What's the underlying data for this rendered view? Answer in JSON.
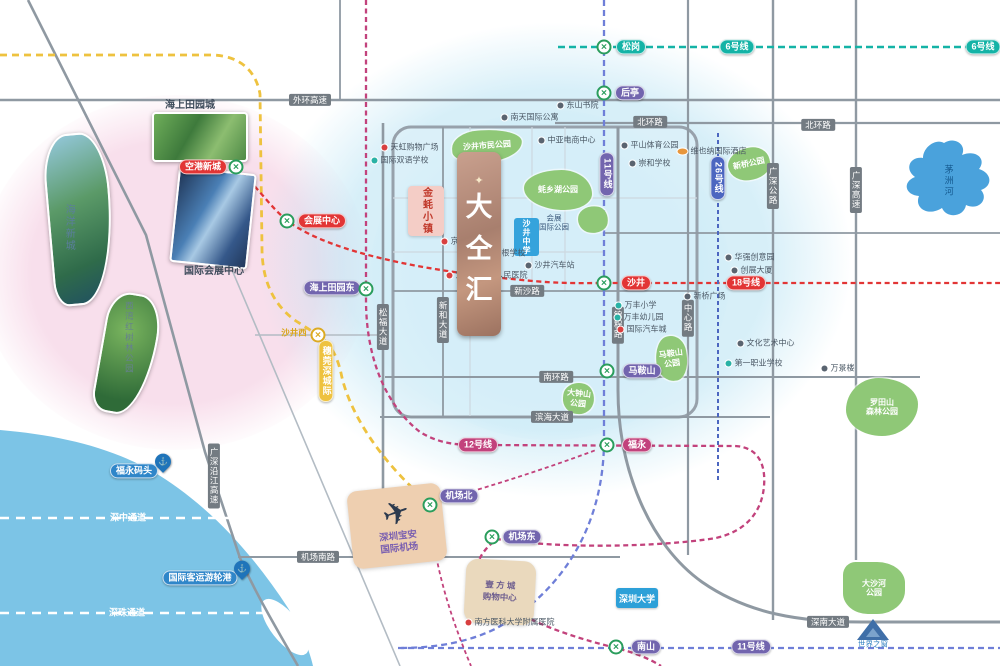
{
  "canvas": {
    "width": 1000,
    "height": 666
  },
  "colors": {
    "sea": "#7cc4e6",
    "river": "#4aa2dc",
    "line6": "#14b3a6",
    "line11": "#6f7fd8",
    "line11_badge": "#7265ae",
    "line12": "#c2427c",
    "line18": "#e23535",
    "line26": "#4c66c0",
    "intercity": "#eec23f",
    "road_badge": "#737b82",
    "park": "#8fc877",
    "station_ring": "#2a9d5c",
    "station_ring_yellow": "#dcaa22"
  },
  "line_badges": [
    {
      "id": "line6-a",
      "text": "6号线",
      "x": 737,
      "y": 47,
      "bg": "#14b3a6"
    },
    {
      "id": "line6-b",
      "text": "6号线",
      "x": 983,
      "y": 47,
      "bg": "#14b3a6"
    },
    {
      "id": "line11-v",
      "text": "11号线",
      "x": 607,
      "y": 174,
      "bg": "#7265ae",
      "vert": true
    },
    {
      "id": "line11-h",
      "text": "11号线",
      "x": 751,
      "y": 647,
      "bg": "#7265ae"
    },
    {
      "id": "line12",
      "text": "12号线",
      "x": 478,
      "y": 445,
      "bg": "#c2427c"
    },
    {
      "id": "line18",
      "text": "18号线",
      "x": 746,
      "y": 283,
      "bg": "#e23535"
    },
    {
      "id": "line26",
      "text": "26号线",
      "x": 718,
      "y": 178,
      "bg": "#4c66c0",
      "vert": true
    },
    {
      "id": "intercity",
      "text": "穗莞深城际",
      "x": 326,
      "y": 371,
      "bg": "#eec23f",
      "vert": true
    }
  ],
  "stations": [
    {
      "id": "songgang",
      "name": "松岗",
      "ix": 604,
      "iy": 47,
      "lx": 631,
      "ly": 47,
      "bg": "#14b3a6"
    },
    {
      "id": "houting",
      "name": "后亭",
      "ix": 604,
      "iy": 93,
      "lx": 630,
      "ly": 93,
      "bg": "#7265ae"
    },
    {
      "id": "shajing",
      "name": "沙井",
      "ix": 604,
      "iy": 283,
      "lx": 636,
      "ly": 283,
      "bg": "#e23535"
    },
    {
      "id": "maanshan",
      "name": "马鞍山",
      "ix": 607,
      "iy": 371,
      "lx": 642,
      "ly": 371,
      "bg": "#7265ae"
    },
    {
      "id": "fuyong",
      "name": "福永",
      "ix": 607,
      "iy": 445,
      "lx": 637,
      "ly": 445,
      "bg": "#c2427c"
    },
    {
      "id": "haishangtianyuandong",
      "name": "海上田园东",
      "ix": 366,
      "iy": 289,
      "lx": 332,
      "ly": 288,
      "bg": "#7265ae"
    },
    {
      "id": "konggangxincheng",
      "name": "空港新城",
      "ix": 236,
      "iy": 167,
      "lx": 203,
      "ly": 167,
      "bg": "#e23535"
    },
    {
      "id": "huizhanzhongxin",
      "name": "会展中心",
      "ix": 287,
      "iy": 221,
      "lx": 322,
      "ly": 221,
      "bg": "#e23535"
    },
    {
      "id": "jichangbei",
      "name": "机场北",
      "ix": 430,
      "iy": 505,
      "lx": 459,
      "ly": 496,
      "bg": "#7265ae"
    },
    {
      "id": "jichangdong",
      "name": "机场东",
      "ix": 492,
      "iy": 537,
      "lx": 522,
      "ly": 537,
      "bg": "#7265ae"
    },
    {
      "id": "nanshan",
      "name": "南山",
      "ix": 616,
      "iy": 647,
      "lx": 646,
      "ly": 647,
      "bg": "#7265ae"
    },
    {
      "id": "shajingxi",
      "name": "沙井西",
      "ix": 318,
      "iy": 335,
      "lx": 294,
      "ly": 333,
      "plain": true,
      "color": "#d9a61e",
      "yellow": true
    }
  ],
  "road_badges": [
    {
      "id": "waihuan-expwy",
      "text": "外环高速",
      "x": 310,
      "y": 100
    },
    {
      "id": "beihuan-rd-1",
      "text": "北环路",
      "x": 650,
      "y": 122
    },
    {
      "id": "beihuan-rd-2",
      "text": "北环路",
      "x": 818,
      "y": 125
    },
    {
      "id": "xinsha-rd",
      "text": "新沙路",
      "x": 527,
      "y": 291
    },
    {
      "id": "nanhuan-rd",
      "text": "南环路",
      "x": 556,
      "y": 377
    },
    {
      "id": "binhai-ave",
      "text": "滨海大道",
      "x": 552,
      "y": 417
    },
    {
      "id": "jichangnan-rd",
      "text": "机场南路",
      "x": 318,
      "y": 557
    },
    {
      "id": "shennan-ave",
      "text": "深南大道",
      "x": 828,
      "y": 622
    },
    {
      "id": "songfu-ave",
      "text": "松福大道",
      "x": 383,
      "y": 327,
      "vert": true
    },
    {
      "id": "xinhe-ave",
      "text": "新和大道",
      "x": 443,
      "y": 320,
      "vert": true
    },
    {
      "id": "jincheng-rd",
      "text": "锦程路",
      "x": 618,
      "y": 325,
      "vert": true
    },
    {
      "id": "zhongxin-rd",
      "text": "中心路",
      "x": 688,
      "y": 318,
      "vert": true
    },
    {
      "id": "guangshen-hwy",
      "text": "广深公路",
      "x": 773,
      "y": 186,
      "vert": true
    },
    {
      "id": "guangshen-expwy",
      "text": "广深高速",
      "x": 856,
      "y": 190,
      "vert": true
    },
    {
      "id": "yanjiang-expwy",
      "text": "广深沿江高速",
      "x": 214,
      "y": 476,
      "vert": true
    }
  ],
  "parks": [
    {
      "id": "shimin-park",
      "lines": [
        "沙井市民公园"
      ],
      "x": 452,
      "y": 130,
      "w": 70,
      "h": 32,
      "rot": -4,
      "br": "40% 60% 55% 45%/55% 45% 60% 40%"
    },
    {
      "id": "haoxianghu-park",
      "lines": [
        "蚝乡湖公园"
      ],
      "x": 524,
      "y": 170,
      "w": 68,
      "h": 40,
      "rot": 0,
      "br": "55% 45% 40% 60%/45% 60% 40% 55%"
    },
    {
      "id": "huizhan-intl-park",
      "lines": [],
      "x": 578,
      "y": 206,
      "w": 30,
      "h": 27,
      "rot": 10,
      "br": "60% 40% 55% 45%/50% 55% 45% 50%"
    },
    {
      "id": "maanshan-park",
      "lines": [
        "马鞍山",
        "公园"
      ],
      "x": 656,
      "y": 336,
      "w": 31,
      "h": 45,
      "rot": -8,
      "br": "50% 50% 45% 55%/60% 40% 55% 45%"
    },
    {
      "id": "dazhongshan-park",
      "lines": [
        "大钟山",
        "公园"
      ],
      "x": 563,
      "y": 383,
      "w": 31,
      "h": 31,
      "rot": 6,
      "br": "55% 45% 50% 50%/45% 55% 50% 50%"
    },
    {
      "id": "luotianshan-park",
      "lines": [
        "罗田山",
        "森林公园"
      ],
      "x": 846,
      "y": 378,
      "w": 72,
      "h": 58,
      "rot": 0,
      "br": "45% 55% 50% 50%/55% 45% 55% 45%"
    },
    {
      "id": "dashahe-park",
      "lines": [
        "大沙河",
        "公园"
      ],
      "x": 843,
      "y": 562,
      "w": 62,
      "h": 52,
      "rot": 0,
      "br": "20% 45% 45% 40%/25% 40% 45% 40%"
    },
    {
      "id": "xinqiao-park",
      "lines": [
        "新桥公园"
      ],
      "x": 728,
      "y": 148,
      "w": 42,
      "h": 32,
      "rot": -12,
      "br": "55% 45% 50% 50%/50% 50% 45% 55%"
    }
  ],
  "pois": [
    {
      "text": "天虹购物广场",
      "x": 410,
      "y": 147,
      "c": "r"
    },
    {
      "text": "国际双语学校",
      "x": 400,
      "y": 160,
      "c": "t"
    },
    {
      "text": "中亚电商中心",
      "x": 567,
      "y": 140,
      "c": "d"
    },
    {
      "text": "荣根学校",
      "x": 505,
      "y": 253,
      "c": "b"
    },
    {
      "text": "京基百纳广场",
      "x": 470,
      "y": 241,
      "c": "r"
    },
    {
      "text": "宝安区沙井人民医院",
      "x": 487,
      "y": 275,
      "c": "r"
    },
    {
      "text": "沙井汽车站",
      "x": 550,
      "y": 265,
      "c": "d"
    },
    {
      "text": "万丰小学",
      "x": 636,
      "y": 305,
      "c": "t"
    },
    {
      "text": "万丰幼儿园",
      "x": 639,
      "y": 317,
      "c": "t"
    },
    {
      "text": "国际汽车城",
      "x": 642,
      "y": 329,
      "c": "r"
    },
    {
      "text": "平山体育公园",
      "x": 650,
      "y": 145,
      "c": "d"
    },
    {
      "text": "崇和学校",
      "x": 650,
      "y": 163,
      "c": "d"
    },
    {
      "text": "东山书院",
      "x": 578,
      "y": 105,
      "c": "d"
    },
    {
      "text": "南天国际公寓",
      "x": 530,
      "y": 117,
      "c": "d"
    },
    {
      "text": "维也纳国际酒店",
      "x": 712,
      "y": 151,
      "c": "o"
    },
    {
      "text": "新桥广场",
      "x": 705,
      "y": 296,
      "c": "d"
    },
    {
      "text": "华强创意园",
      "x": 750,
      "y": 257,
      "c": "d"
    },
    {
      "text": "创展大厦",
      "x": 752,
      "y": 270,
      "c": "d"
    },
    {
      "text": "文化艺术中心",
      "x": 766,
      "y": 343,
      "c": "d"
    },
    {
      "text": "第一职业学校",
      "x": 754,
      "y": 363,
      "c": "t"
    },
    {
      "text": "万景楼",
      "x": 838,
      "y": 368,
      "c": "d"
    },
    {
      "text": "南方医科大学附属医院",
      "x": 510,
      "y": 622,
      "c": "r"
    }
  ],
  "texts": [
    {
      "id": "haishang-tianyuan-label",
      "lines": [
        "海上田园城"
      ],
      "x": 190,
      "y": 106,
      "s": 10,
      "c": "#3f4c5c",
      "b": 1
    },
    {
      "id": "exhibition-center-label",
      "lines": [
        "国际会展中心"
      ],
      "x": 214,
      "y": 272,
      "s": 10,
      "c": "#3f4c5c",
      "b": 1
    },
    {
      "id": "ocean-newtown-label",
      "lines": [
        "海洋新城"
      ],
      "x": 68,
      "y": 228,
      "s": 10,
      "c": "#5b7e9e",
      "v": 1
    },
    {
      "id": "mangrove-park-label",
      "lines": [
        "西湾红树林公园"
      ],
      "x": 129,
      "y": 338,
      "s": 8.5,
      "c": "#66808f",
      "v": 1
    },
    {
      "id": "maozhou-river-label",
      "lines": [
        "茅洲河"
      ],
      "x": 948,
      "y": 181,
      "s": 9,
      "c": "#14598f",
      "v": 1
    },
    {
      "id": "shenzhong-corridor-label",
      "lines": [
        "深中通道"
      ],
      "x": 128,
      "y": 518,
      "s": 9,
      "c": "#ffffff",
      "b": 1
    },
    {
      "id": "shenzhu-corridor-label",
      "lines": [
        "深珠通道"
      ],
      "x": 127,
      "y": 613,
      "s": 9,
      "c": "#ffffff",
      "b": 1
    },
    {
      "id": "window-of-world-label",
      "lines": [
        "世界之窗"
      ],
      "x": 873,
      "y": 644,
      "s": 7.5,
      "c": "#2d7fc0"
    },
    {
      "id": "huizhan-intl-park-label",
      "lines": [
        "会展",
        "国际公园"
      ],
      "x": 554,
      "y": 223,
      "s": 7.5,
      "c": "#3c5a7d"
    }
  ],
  "photos": [
    {
      "id": "haishang-tianyuan-photo",
      "g": "g1",
      "x": 152,
      "y": 112,
      "w": 96,
      "h": 50,
      "rot": 0,
      "br": "4px"
    },
    {
      "id": "exhibition-center-photo",
      "g": "g2",
      "x": 174,
      "y": 170,
      "w": 78,
      "h": 96,
      "rot": 6,
      "br": "4px"
    },
    {
      "id": "mangrove-photo",
      "g": "g3",
      "x": 100,
      "y": 293,
      "w": 55,
      "h": 122,
      "rot": 10,
      "br": "48% 52% 65% 35%/30% 40% 80% 20%"
    },
    {
      "id": "ocean-newtown-photo",
      "g": "g4",
      "x": 48,
      "y": 133,
      "w": 64,
      "h": 172,
      "rot": -5,
      "br": "50% 50% 72% 28%/35% 42% 82% 18%"
    }
  ],
  "landmarks": {
    "logo": {
      "crown": "✦",
      "chars": [
        "大",
        "仝",
        "汇"
      ],
      "x": 457,
      "y": 152,
      "w": 44,
      "h": 184
    },
    "oyster_town": {
      "text": "金蚝小镇",
      "x": 408,
      "y": 186,
      "w": 36,
      "h": 50
    },
    "blue_school": {
      "text": "沙井中学",
      "x": 514,
      "y": 218,
      "w": 25,
      "h": 38
    },
    "airport": {
      "plane": "✈",
      "lines": [
        "深圳宝安",
        "国际机场"
      ],
      "x": 350,
      "y": 487,
      "w": 94,
      "h": 78,
      "rot": -6
    },
    "mall": {
      "lines": [
        "壹 方 城",
        "购物中心"
      ],
      "x": 465,
      "y": 560,
      "w": 70,
      "h": 64,
      "rot": 3
    },
    "university_badge": {
      "text": "深圳大学",
      "x": 616,
      "y": 588,
      "w": 42,
      "h": 20
    },
    "window_of_world": {
      "x": 873,
      "y": 640
    },
    "ferries": [
      {
        "id": "fuyong-ferry",
        "text": "福永码头",
        "px": 163,
        "py": 468,
        "lx": 134,
        "ly": 471
      },
      {
        "id": "intl-cruise-port",
        "text": "国际客运游轮港",
        "px": 242,
        "py": 575,
        "lx": 200,
        "ly": 578
      }
    ]
  }
}
